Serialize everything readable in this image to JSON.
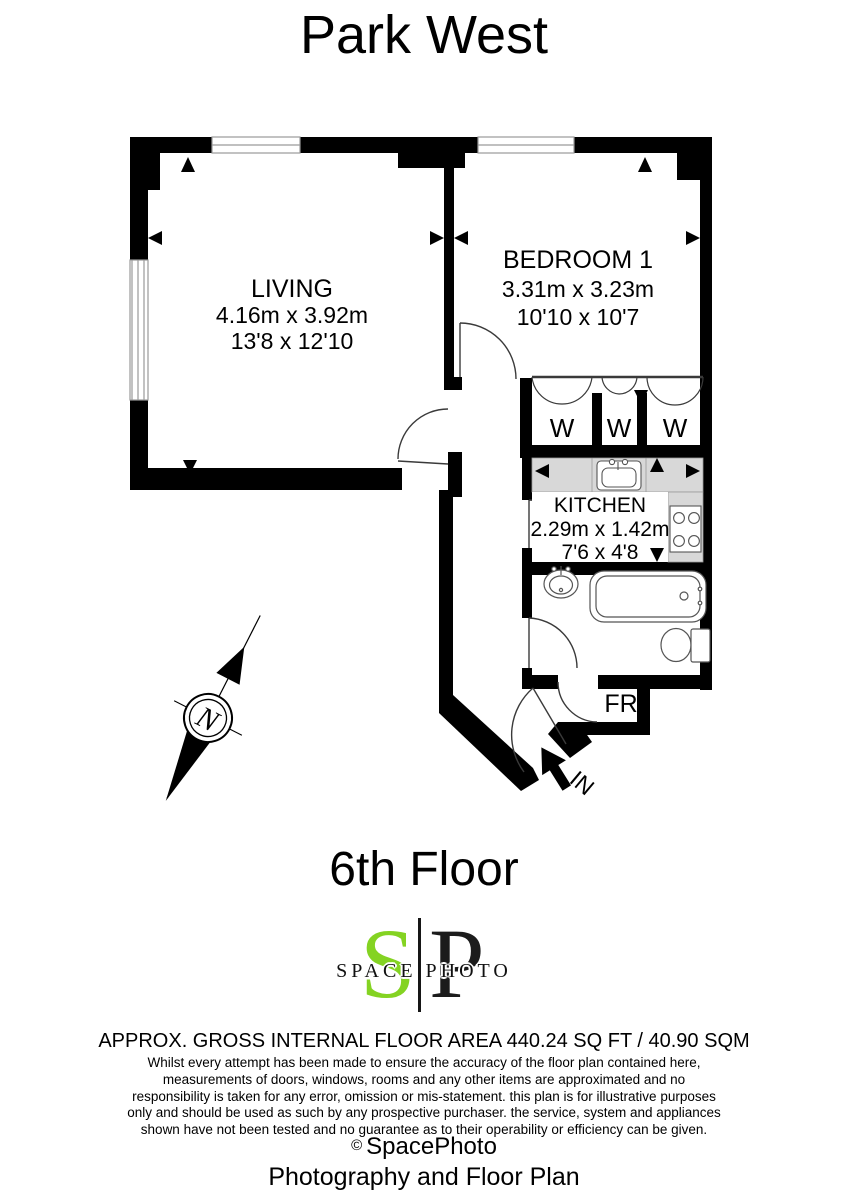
{
  "title": "Park West",
  "plan": {
    "living": {
      "name": "LIVING",
      "metric": "4.16m x 3.92m",
      "imperial": "13'8 x 12'10"
    },
    "bedroom": {
      "name": "BEDROOM 1",
      "metric": "3.31m x 3.23m",
      "imperial": "10'10 x 10'7"
    },
    "kitchen": {
      "name": "KITCHEN",
      "metric": "2.29m x 1.42m",
      "imperial": "7'6 x 4'8"
    },
    "wardrobes": [
      "W",
      "W",
      "W"
    ],
    "fr_label": "FR",
    "entrance_label": "IN",
    "compass_letter": "N"
  },
  "floor_label": "6th Floor",
  "logo": {
    "letter_s": "S",
    "letter_p": "P",
    "wordmark": "SPACE PHOTO",
    "green": "#84d322"
  },
  "footer": {
    "area_line": "APPROX. GROSS INTERNAL FLOOR AREA 440.24 SQ FT / 40.90 SQM",
    "disclaimer_lines": [
      "Whilst every attempt has been made to ensure the accuracy of the floor plan contained here,",
      "measurements of doors, windows, rooms and any other items are approximated and no",
      "responsibility is taken for any error, omission or mis-statement. this plan is for illustrative purposes",
      "only and should be used as such by any prospective purchaser. the service, system and appliances",
      "shown have not been tested and no guarantee as to their operability or efficiency can be given."
    ],
    "copyright_symbol": "©",
    "copyright_name": "SpacePhoto",
    "tagline": "Photography and Floor Plan"
  },
  "colors": {
    "wall": "#000000",
    "counter_grey": "#d8d8d8",
    "logo_green": "#84d322"
  }
}
